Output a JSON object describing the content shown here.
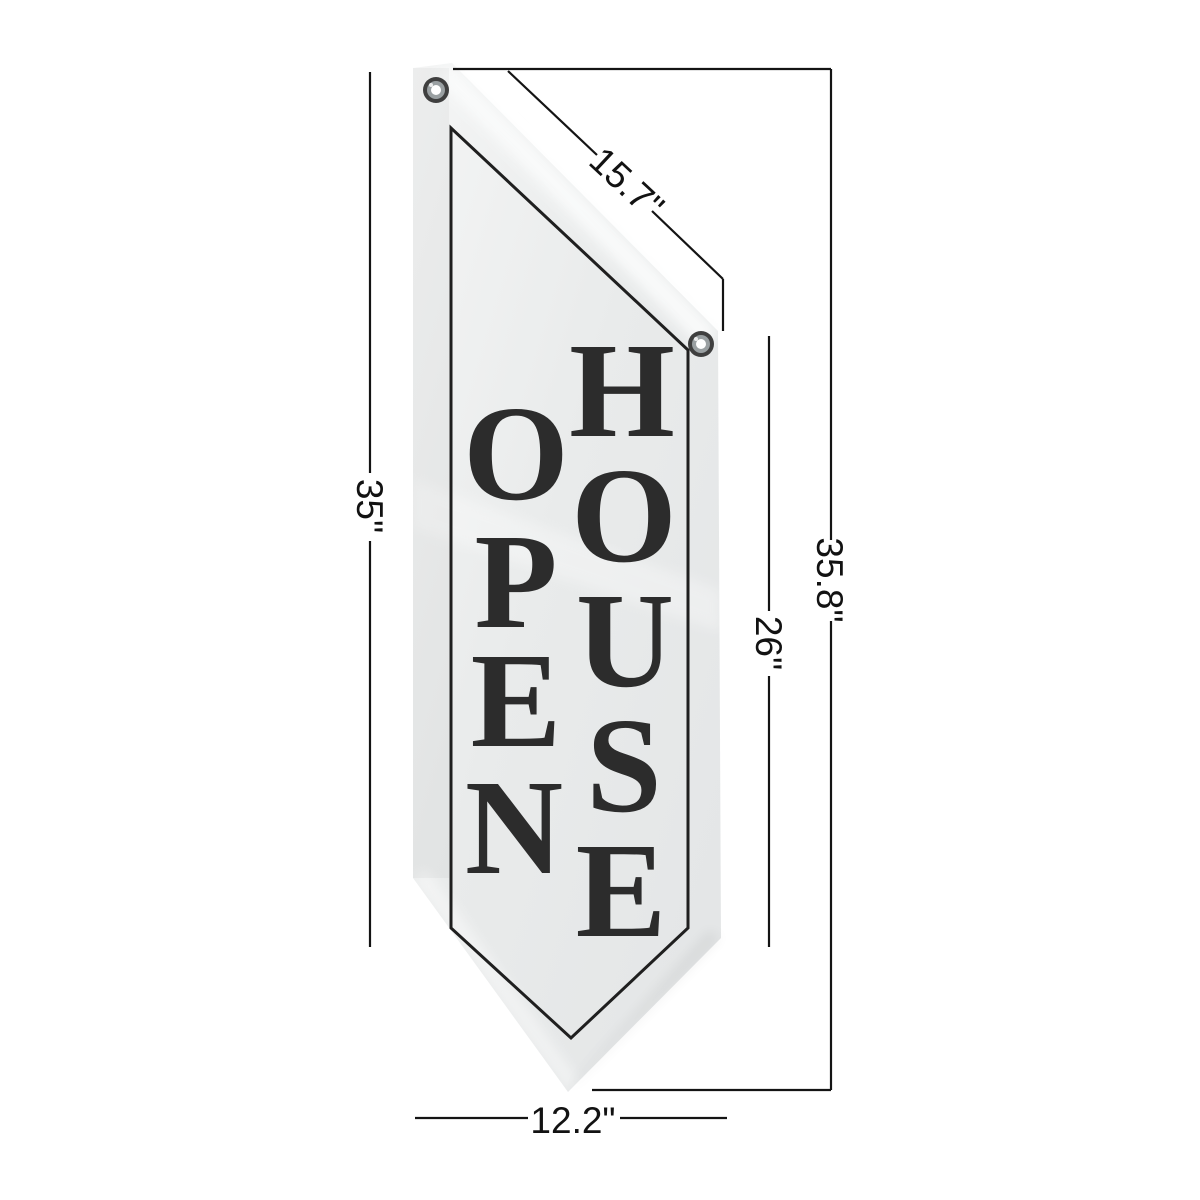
{
  "scene": {
    "description": "Open House vertical pennant banner product dimension diagram"
  },
  "banner": {
    "word_left": "OPEN",
    "word_right": "HOUSE",
    "letters_left": [
      "O",
      "P",
      "E",
      "N"
    ],
    "letters_right": [
      "H",
      "O",
      "U",
      "S",
      "E"
    ],
    "grommet_count": "2"
  },
  "dimensions": {
    "top_edge": "15.7\"",
    "left_height": "35\"",
    "right_straight_edge": "26\"",
    "overall_height": "35.8\"",
    "bottom_width": "12.2\""
  },
  "colors": {
    "background": "#ffffff",
    "fabric": "#eaecec",
    "fabric_highlight": "#fbfcfc",
    "letters": "#2c2c2c",
    "border_line": "#1f1f1f",
    "dimension_line": "#141414",
    "grommet_rim": "#3f3f3f"
  }
}
